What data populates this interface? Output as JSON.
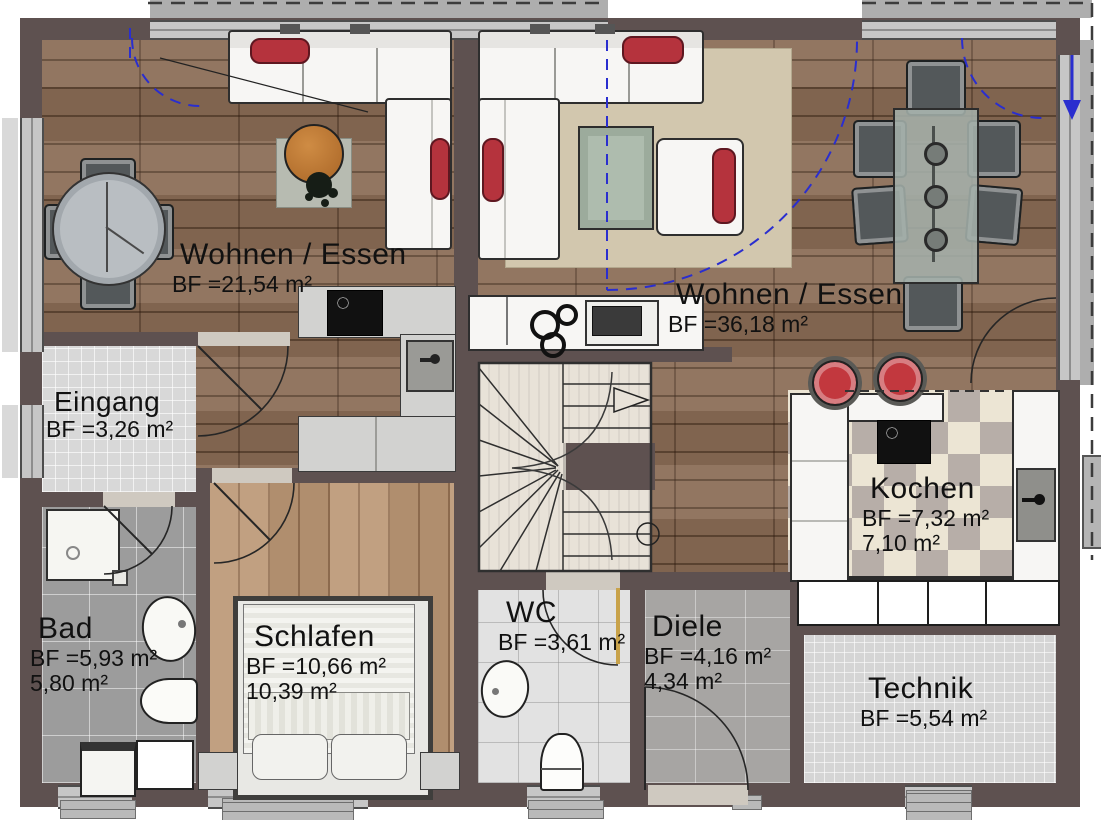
{
  "plan": {
    "rooms": [
      {
        "id": "wohnen-essen-left",
        "name": "Wohnen / Essen",
        "area1": "BF =21,54 m²",
        "area2": ""
      },
      {
        "id": "wohnen-essen-right",
        "name": "Wohnen / Essen",
        "area1": "BF =36,18 m²",
        "area2": ""
      },
      {
        "id": "eingang",
        "name": "Eingang",
        "area1": "BF =3,26 m²",
        "area2": ""
      },
      {
        "id": "kochen",
        "name": "Kochen",
        "area1": "BF =7,32 m²",
        "area2": "7,10 m²"
      },
      {
        "id": "bad",
        "name": "Bad",
        "area1": "BF =5,93 m²",
        "area2": "5,80 m²"
      },
      {
        "id": "schlafen",
        "name": "Schlafen",
        "area1": "BF =10,66 m²",
        "area2": "10,39 m²"
      },
      {
        "id": "wc",
        "name": "WC",
        "area1": "BF =3,61 m²",
        "area2": ""
      },
      {
        "id": "diele",
        "name": "Diele",
        "area1": "BF =4,16 m²",
        "area2": "4,34 m²"
      },
      {
        "id": "technik",
        "name": "Technik",
        "area1": "BF =5,54 m²",
        "area2": ""
      }
    ],
    "colors": {
      "wall": "#5e5150",
      "accent_red": "#b5333d",
      "swing_blue": "#2a2ecf",
      "wood_floor": "#8a6c55"
    },
    "icons": {
      "stair_direction": "arrow-right",
      "entry_direction": "arrow-down"
    }
  }
}
